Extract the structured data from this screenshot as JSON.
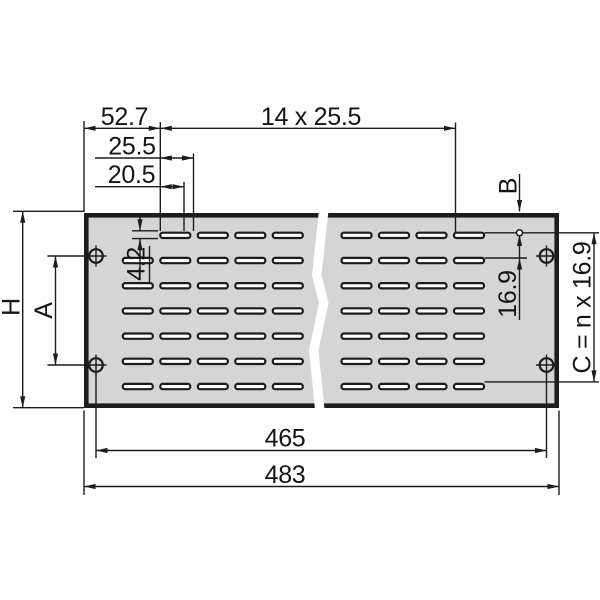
{
  "colors": {
    "background": "#ffffff",
    "panel_fill": "#d4d5d4",
    "line_color": "#1c1c1c",
    "slot_fill": "#ffffff",
    "text_color": "#141414"
  },
  "dimensions": {
    "offset_52_7": "52.7",
    "slot_pattern_14x25_5": "14 x 25.5",
    "pitch_25_5": "25.5",
    "slot_length_20_5": "20.5",
    "slot_height_4_2": "4.2",
    "panel_height_label": "H",
    "hole_spacing_label": "A",
    "top_margin_label": "B",
    "row_pitch_16_9": "16.9",
    "c_formula": "C = n x 16.9",
    "hole_span_465": "465",
    "overall_width_483": "483"
  }
}
